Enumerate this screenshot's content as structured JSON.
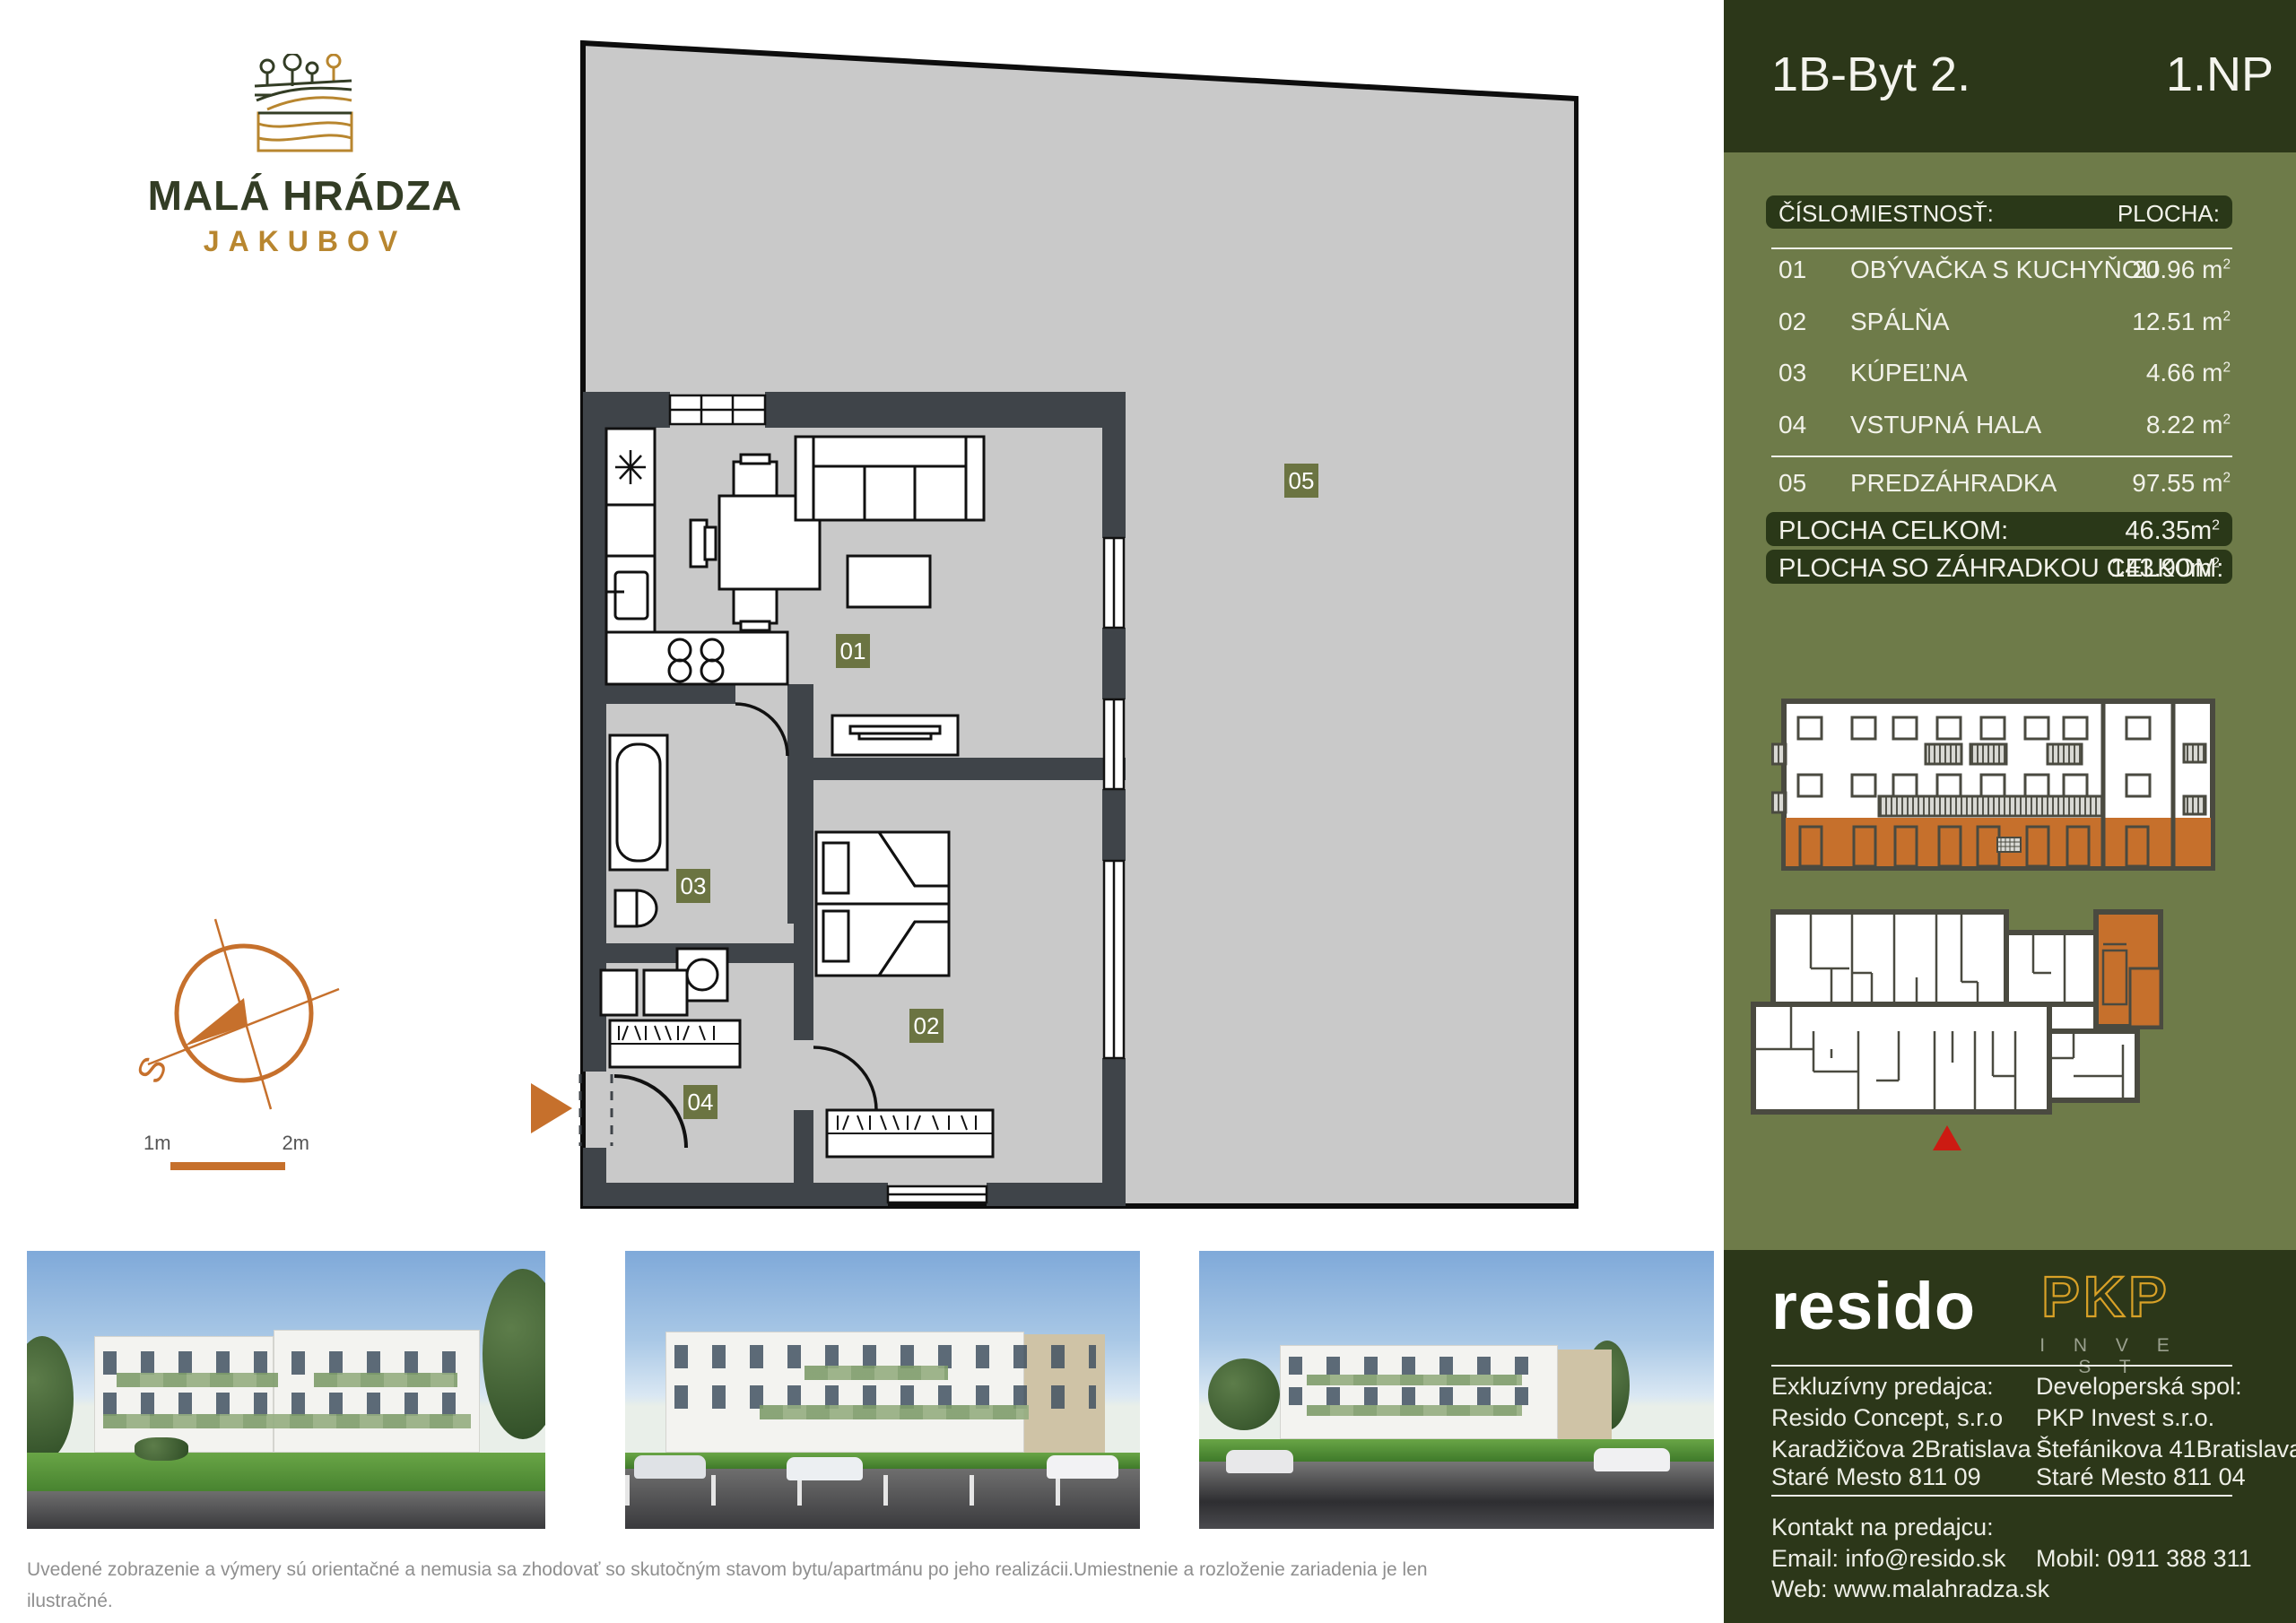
{
  "header": {
    "unit": "1B-Byt 2.",
    "floor": "1.NP"
  },
  "logo": {
    "title": "MALÁ HRÁDZA",
    "subtitle": "JAKUBOV"
  },
  "table": {
    "col_number": "ČÍSLO:",
    "col_room": "MIESTNOSŤ:",
    "col_area": "PLOCHA:",
    "area_unit": "m",
    "area_sup": "2",
    "rows": [
      {
        "num": "01",
        "room": "OBÝVAČKA S KUCHYŇOU",
        "area": "20.96"
      },
      {
        "num": "02",
        "room": "SPÁLŇA",
        "area": "12.51"
      },
      {
        "num": "03",
        "room": "KÚPEĽNA",
        "area": "4.66"
      },
      {
        "num": "04",
        "room": "VSTUPNÁ HALA",
        "area": "8.22"
      },
      {
        "num": "05",
        "room": "PREDZÁHRADKA",
        "area": "97.55"
      }
    ],
    "total_label": "PLOCHA CELKOM:",
    "total_value": "46.35",
    "total_garden_label": "PLOCHA SO ZÁHRADKOU CELKOM:",
    "total_garden_value": "143.90"
  },
  "plan": {
    "labels": [
      "01",
      "02",
      "03",
      "04",
      "05"
    ],
    "scale_left": "1m",
    "scale_right": "2m",
    "compass_s": "S"
  },
  "footer": {
    "resido_logo": "resido",
    "pkp_logo": "PKP",
    "pkp_sub": "I N V E S T",
    "seller_heading": "Exkluzívny predajca:",
    "seller_line1": "Resido Concept, s.r.o",
    "seller_line2": "Karadžičova 2Bratislava -",
    "seller_line3": "Staré Mesto 811 09",
    "developer_heading": "Developerská spol:",
    "developer_line1": "PKP Invest s.r.o.",
    "developer_line2": "Štefánikova 41Bratislava -",
    "developer_line3": "Staré Mesto 811 04",
    "contact_heading": "Kontakt na predajcu:",
    "email": "Email: info@resido.sk",
    "web": "Web: www.malahradza.sk",
    "mobile": "Mobil: 0911 388 311"
  },
  "disclaimer": {
    "line1": "Uvedené zobrazenie a výmery sú orientačné a nemusia sa zhodovať so skutočným stavom bytu/apartmánu po jeho realizácii.Umiestnenie a rozloženie zariadenia je len ilustračné.",
    "line2": "Rozsah budovaného štandardu je popísaný v technickej špecifikácii projektu, ktorá je prílohou Zmluvy o budúcej kúpnej zmluve."
  },
  "colors": {
    "accent_orange": "#C6702C",
    "dark_green": "#2C3719",
    "sidebar_olive": "#6E7B49",
    "label_olive": "#6B7442",
    "gold": "#D8A127",
    "marker_red": "#CC1B12",
    "lot_gray": "#C9C9C9",
    "wall_gray": "#3F4449"
  }
}
